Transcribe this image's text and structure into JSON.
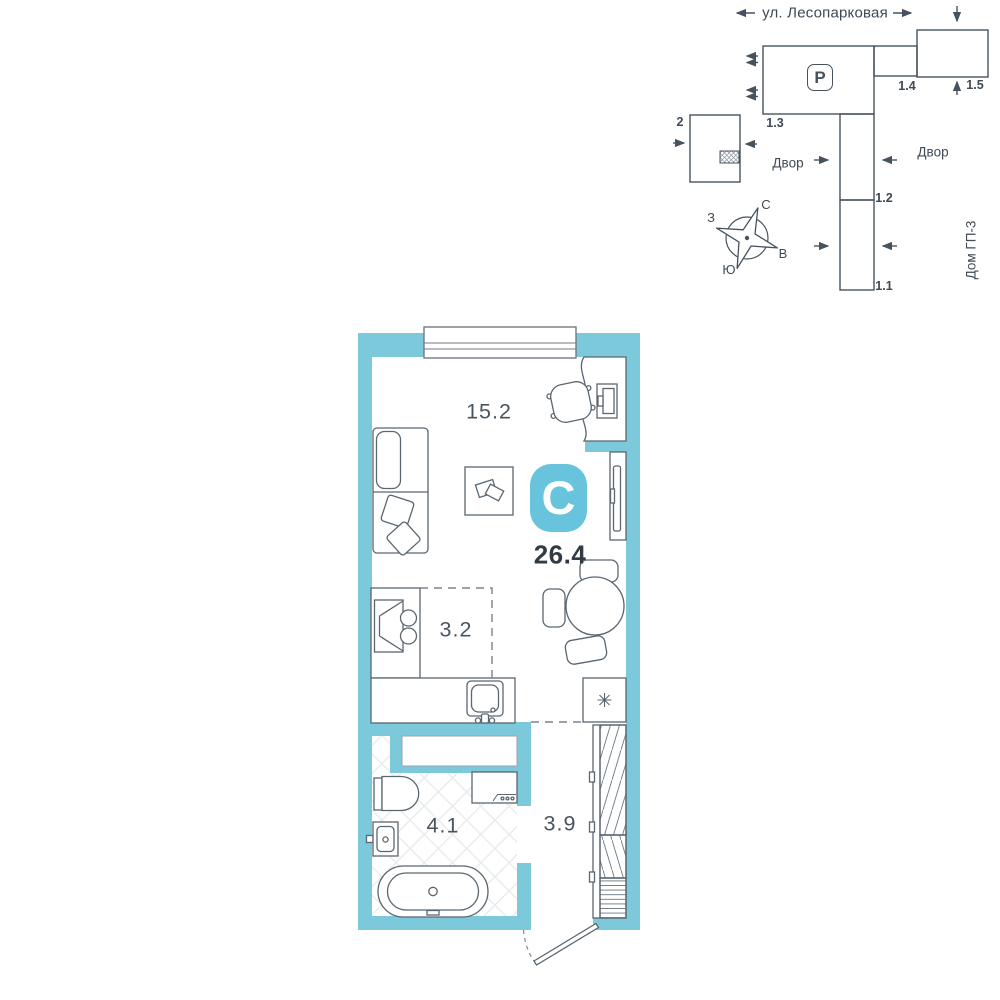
{
  "site_plan": {
    "street": "ул. Лесопарковая",
    "courtyard_left": "Двор",
    "courtyard_right": "Двор",
    "house_ref": "Дом ГП-3",
    "parking": "P",
    "buildings": {
      "b2": "2",
      "b13": "1.3",
      "b14": "1.4",
      "b15": "1.5",
      "b12": "1.2",
      "b11": "1.1"
    },
    "compass": {
      "north": "С",
      "south": "Ю",
      "west": "З",
      "east": "В"
    }
  },
  "apartment": {
    "type_badge": "С",
    "total_area": "26.4",
    "rooms": {
      "living": "15.2",
      "kitchen": "3.2",
      "bathroom": "4.1",
      "hallway": "3.9"
    }
  },
  "icons": {
    "snowflake": "✳",
    "parking": "P"
  },
  "colors": {
    "wall": "#7CC9DC",
    "badge": "#68C3DC",
    "furniture_line": "#5A6670",
    "site_line": "#46525E",
    "text": "#44505A",
    "strong_text": "#323B44"
  }
}
